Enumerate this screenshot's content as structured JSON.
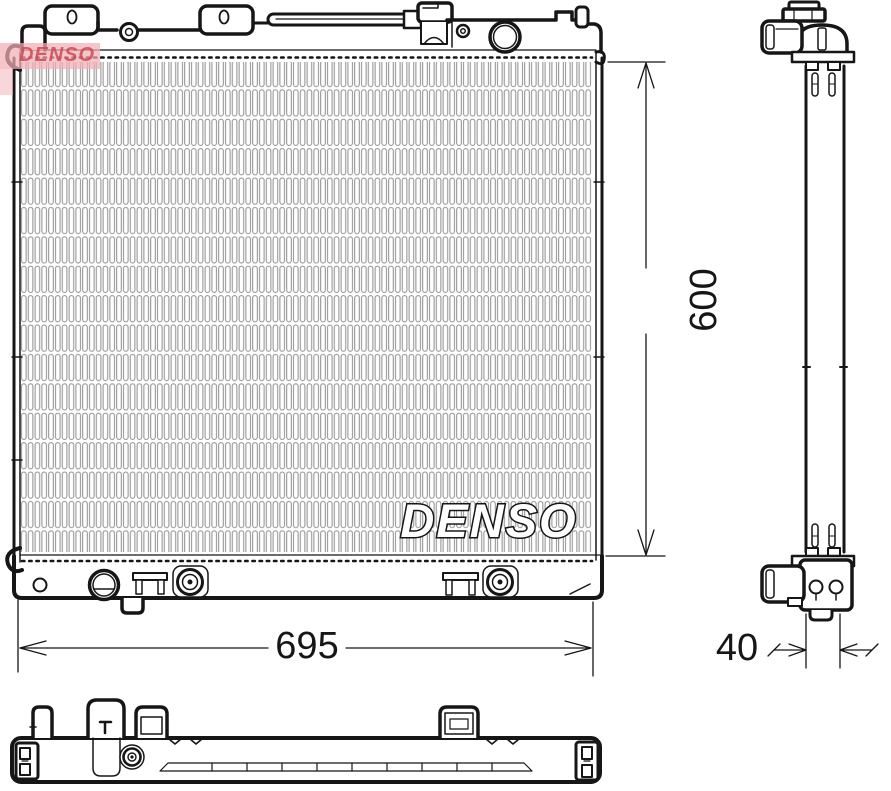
{
  "drawing": {
    "type": "radiator-technical-drawing",
    "brand": "DENSO",
    "views": {
      "front": "front view with finned core",
      "side": "right side profile view",
      "bottom": "bottom tank plan view"
    },
    "watermarks": {
      "corner_logo": "DENSO",
      "core_logo": "DENSO"
    },
    "dimensions": {
      "core_height_mm": "600",
      "overall_width_mm": "695",
      "depth_mm": "40"
    },
    "colors": {
      "line": "#161616",
      "fin_stroke": "#8d8d8d",
      "background": "#ffffff",
      "watermark_pink": "#f2aeb6",
      "watermark_red": "#cf4956"
    }
  }
}
